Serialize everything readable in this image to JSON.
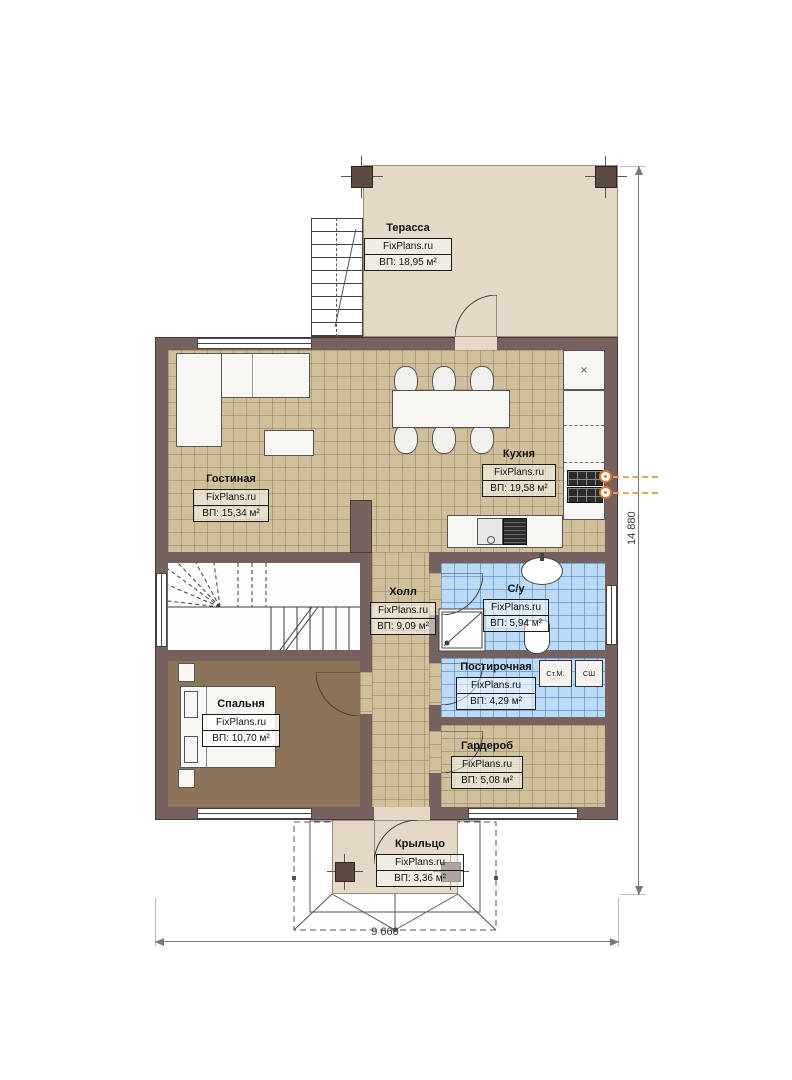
{
  "plan": {
    "watermark": "FixPlans.ru",
    "rooms": [
      {
        "name": "Терасса",
        "area": "ВП: 18,95 м²"
      },
      {
        "name": "Гостиная",
        "area": "ВП: 15,34 м²"
      },
      {
        "name": "Кухня",
        "area": "ВП: 19,58 м²"
      },
      {
        "name": "Холл",
        "area": "ВП: 9,09 м²"
      },
      {
        "name": "С/у",
        "area": "ВП: 5,94 м²"
      },
      {
        "name": "Постирочная",
        "area": "ВП: 4,29 м²"
      },
      {
        "name": "Спальня",
        "area": "ВП: 10,70 м²"
      },
      {
        "name": "Гардероб",
        "area": "ВП: 5,08 м²"
      },
      {
        "name": "Крыльцо",
        "area": "ВП: 3,36 м²"
      }
    ],
    "appliances": {
      "washing_machine": "Ст.М.",
      "dryer": "СШ"
    },
    "dimensions": {
      "overall_width": "9 660",
      "overall_height": "14 880"
    },
    "symbols": {
      "corner_unit": "×"
    },
    "colors": {
      "wall": "#75625f",
      "floor_tile_tan": "#cfc09b",
      "floor_tile_blue": "#badaf5",
      "floor_bedroom": "#8b7458",
      "terrace_floor": "#e3d9c6",
      "accent_orange": "#d9782f"
    }
  }
}
